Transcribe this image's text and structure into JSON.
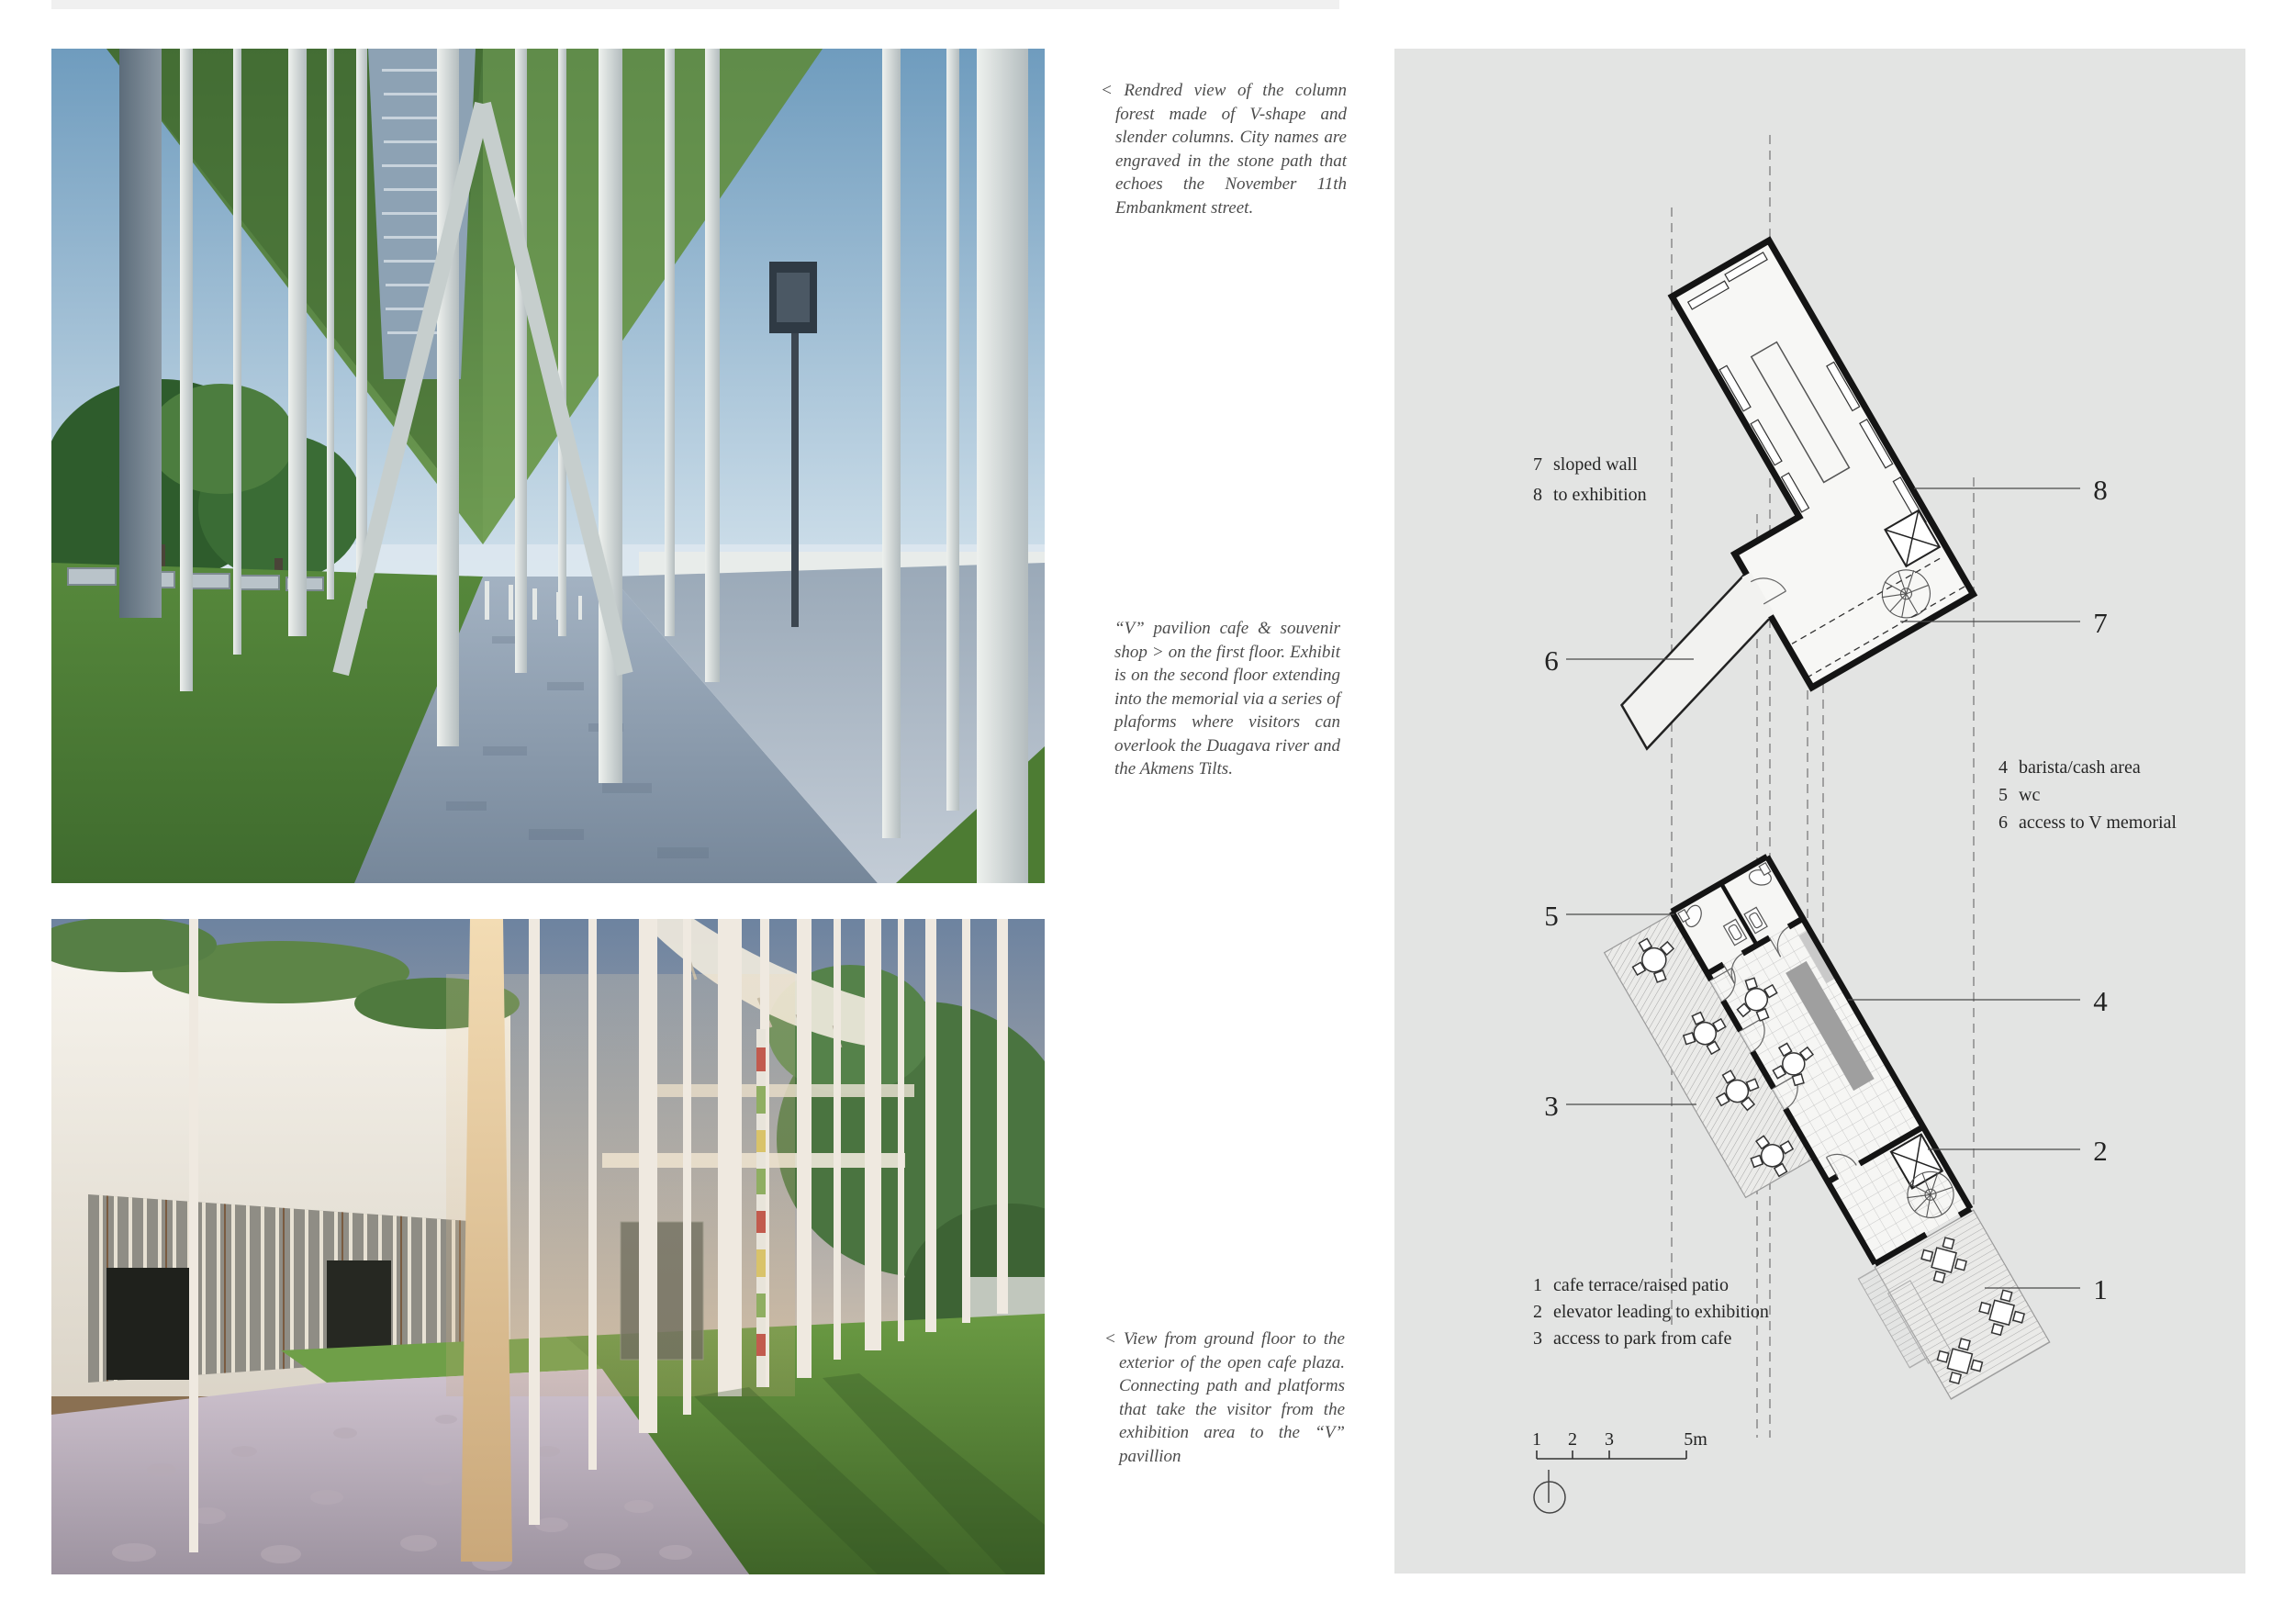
{
  "colors": {
    "panel_bg": "#e3e4e3",
    "wall": "#141414",
    "hatch": "#a5a5a5",
    "counter_gray": "#9f9f9f"
  },
  "captions": {
    "render_top": "< Rendred view of the column forest made of V-shape and slender columns. City names are engraved in the stone path that echoes the November 11th Embankment street.",
    "pavilion": "“V” pavilion cafe & souvenir shop > on the first floor. Exhibit is on the second floor extending into the memorial via a series of plaforms where visitors can overlook the Duagava river and the Akmens Tilts.",
    "render_bottom": "< View from ground floor to the exterior of the open cafe plaza. Connecting path and platforms that take the visitor from the exhibition area to the “V” pavillion"
  },
  "plan": {
    "legend_upper": [
      {
        "num": "7",
        "label": "sloped wall"
      },
      {
        "num": "8",
        "label": "to exhibition"
      }
    ],
    "legend_mid": [
      {
        "num": "4",
        "label": "barista/cash area"
      },
      {
        "num": "5",
        "label": "wc"
      },
      {
        "num": "6",
        "label": "access to V memorial"
      }
    ],
    "legend_lower": [
      {
        "num": "1",
        "label": "cafe terrace/raised patio"
      },
      {
        "num": "2",
        "label": "elevator leading to exhibition"
      },
      {
        "num": "3",
        "label": "access to park from cafe"
      }
    ],
    "callouts": {
      "n1": "1",
      "n2": "2",
      "n3": "3",
      "n4": "4",
      "n5": "5",
      "n6": "6",
      "n7": "7",
      "n8": "8"
    },
    "scale": {
      "t1": "1",
      "t2": "2",
      "t3": "3",
      "t4": "5m"
    }
  }
}
